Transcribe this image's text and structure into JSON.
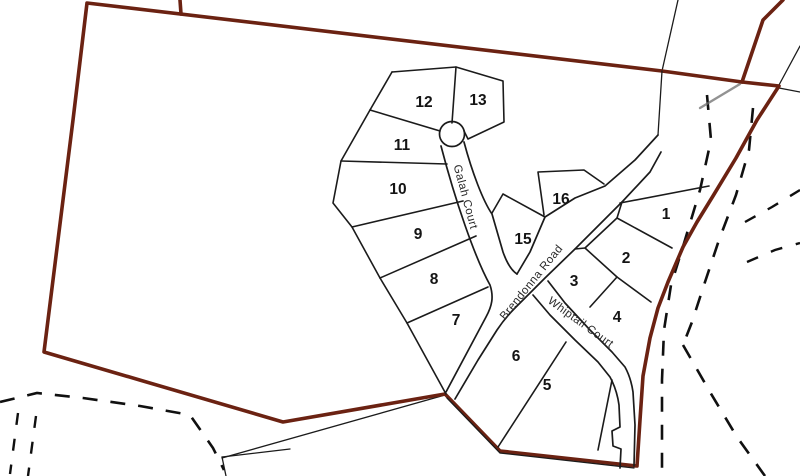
{
  "map": {
    "type": "subdivision-lot-plan",
    "boundary_color": "#6b2212",
    "line_color": "#1b1b1b",
    "lots": [
      {
        "label": "1"
      },
      {
        "label": "2"
      },
      {
        "label": "3"
      },
      {
        "label": "4"
      },
      {
        "label": "5"
      },
      {
        "label": "6"
      },
      {
        "label": "7"
      },
      {
        "label": "8"
      },
      {
        "label": "9"
      },
      {
        "label": "10"
      },
      {
        "label": "11"
      },
      {
        "label": "12"
      },
      {
        "label": "13"
      },
      {
        "label": "15"
      },
      {
        "label": "16"
      }
    ],
    "streets": [
      {
        "name": "Galah Court"
      },
      {
        "name": "Brendonna Road"
      },
      {
        "name": "Whiptail Court"
      }
    ]
  }
}
